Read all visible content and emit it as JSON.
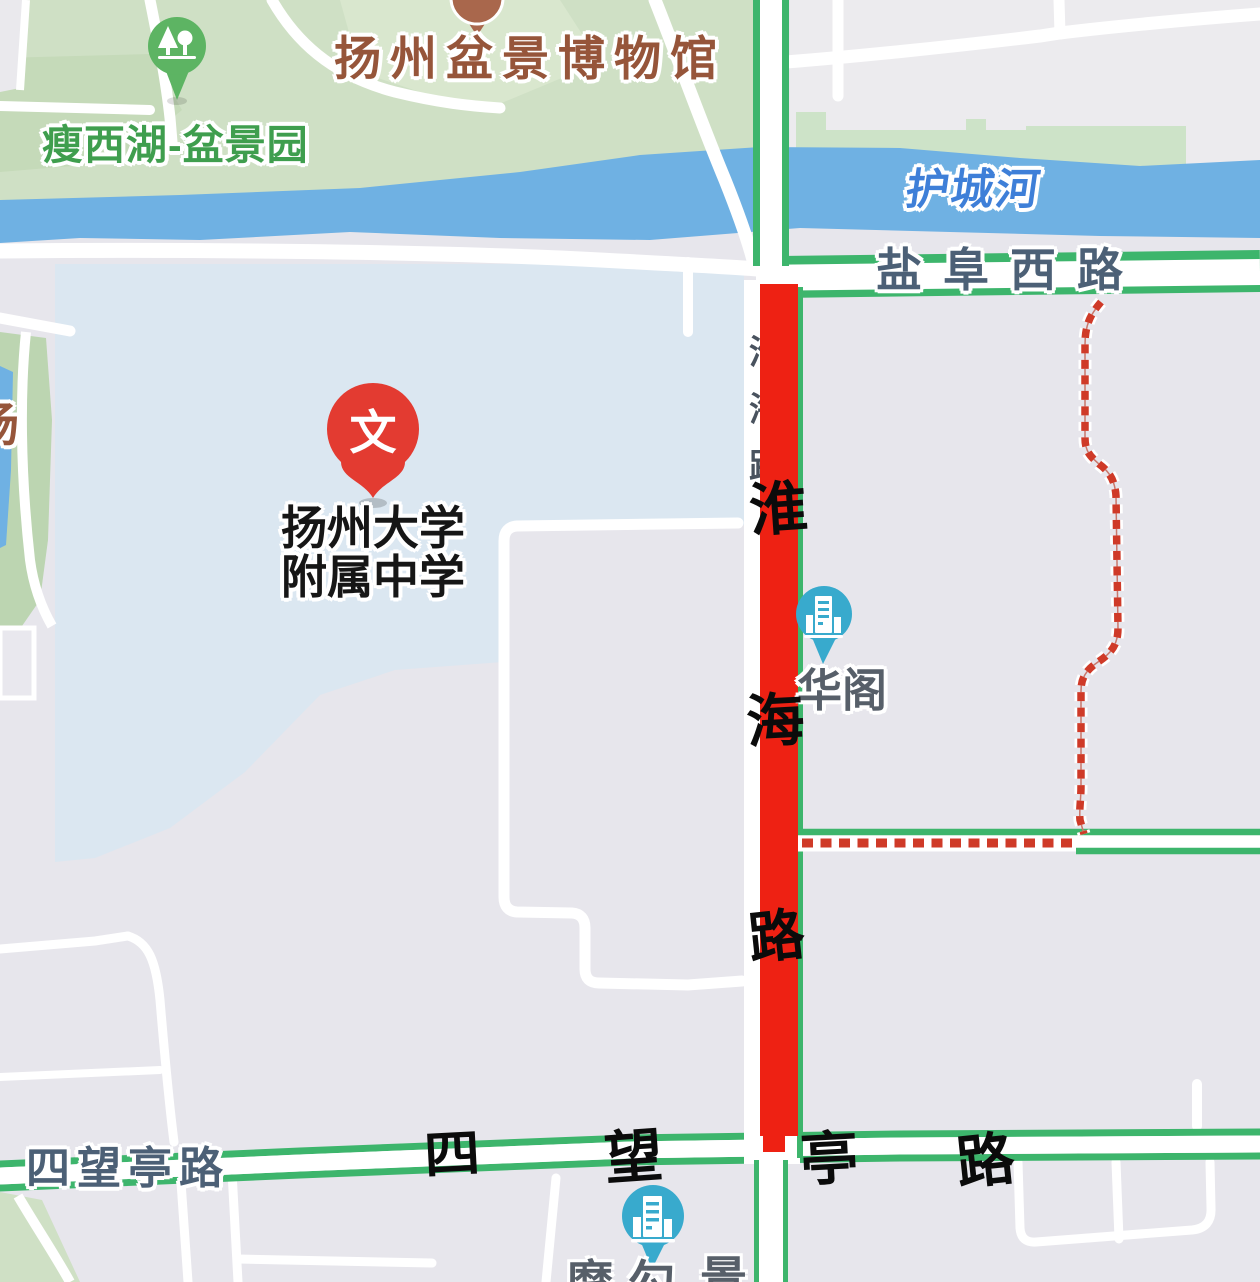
{
  "map_type": "street-map",
  "colors": {
    "park_green": "#cfe0c5",
    "river_blue": "#6fb1e3",
    "campus_blue": "#dbe7f1",
    "urban_gray": "#e7e6ec",
    "road_edge_green": "#3db56c",
    "closed_road_red": "#ee2113",
    "detour_dash_red": "#cf3a28",
    "poi_teal": "#38aacd",
    "pin_red": "#e33b31",
    "marker_green": "#5db463",
    "marker_brown": "#a9674c"
  },
  "poi": {
    "museum": {
      "label": "扬州盆景博物馆"
    },
    "garden": {
      "label": "瘦西湖-盆景园"
    },
    "school": {
      "label_line1": "扬州大学",
      "label_line2": "附属中学",
      "pin_glyph": "文"
    },
    "huage": {
      "label": "华阁"
    },
    "bottom_partial": {
      "chars": [
        "摩",
        "勾",
        "景"
      ]
    }
  },
  "roads": {
    "river_name": "护城河",
    "yanfu_west_road": "盐阜西路",
    "siwangting_road": "四望亭路",
    "huaihai_small_vertical": [
      "淮",
      "海",
      "路"
    ],
    "huaihai_calligraphy": [
      "淮",
      "海",
      "路"
    ],
    "siwangting_calligraphy": [
      "四",
      "望",
      "亭",
      "路"
    ],
    "partial_left_char": "场"
  }
}
